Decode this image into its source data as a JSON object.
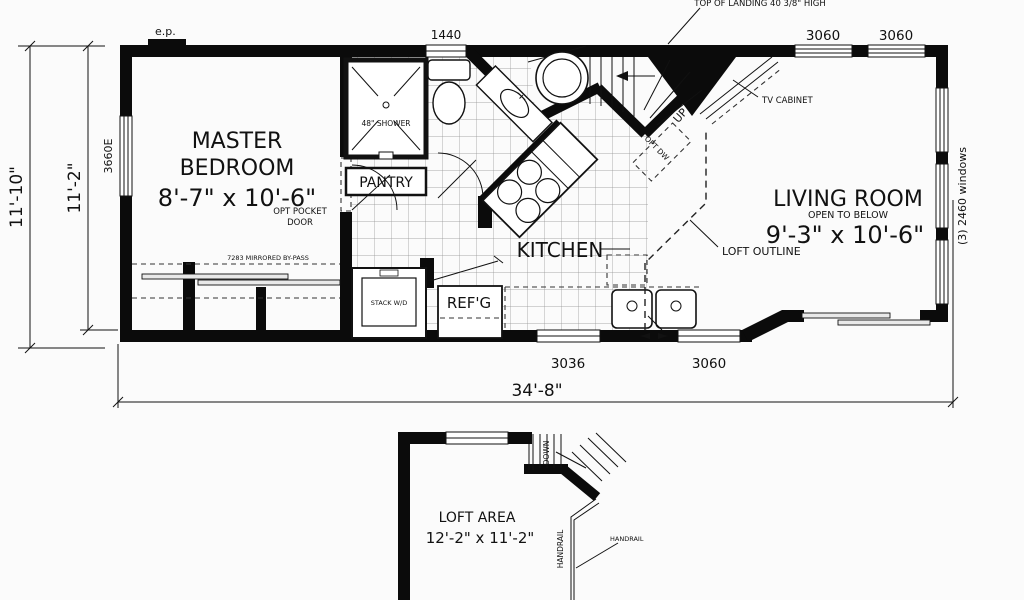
{
  "title": "Park model floor plan",
  "colors": {
    "background": "#fbfbfb",
    "ink": "#0b0b0b",
    "grid": "#8f8f8f"
  },
  "main_plan": {
    "rooms": {
      "master_bedroom": {
        "line1": "MASTER",
        "line2": "BEDROOM",
        "size": "8'-7\" x 10'-6\""
      },
      "kitchen": {
        "name": "KITCHEN"
      },
      "living_room": {
        "name": "LIVING ROOM",
        "subtitle": "OPEN TO BELOW",
        "size": "9'-3\" x 10'-6\""
      },
      "pantry": {
        "name": "PANTRY"
      }
    },
    "fixtures": {
      "shower": "48\" SHOWER",
      "stack_washer_dryer": "STACK W/D",
      "refrigerator": "REF'G",
      "opt_dishwasher": "OPT DW",
      "tv_cabinet": "TV CABINET"
    },
    "annotations": {
      "electrical_panel": "e.p.",
      "top_of_landing": "TOP OF LANDING 40 3/8\" HIGH",
      "up": "UP",
      "opt_pocket_door_line1": "OPT POCKET",
      "opt_pocket_door_line2": "DOOR",
      "mirrored_bypass": "7283 MIRRORED BY-PASS",
      "loft_outline": "LOFT OUTLINE"
    },
    "windows": {
      "top_bath": "1440",
      "top_right_1": "3060",
      "top_right_2": "3060",
      "left_bedroom": "3660E",
      "right_side": "(3) 2460 windows",
      "bottom_kitchen": "3036",
      "bottom_living": "3060"
    },
    "dimensions": {
      "overall_width": "34'-8\"",
      "overall_height": "11'-10\"",
      "interior_height": "11'-2\""
    }
  },
  "loft_plan": {
    "room": {
      "name": "LOFT AREA",
      "size": "12'-2\" x 11'-2\""
    },
    "annotations": {
      "down": "DOWN",
      "handrail_rail": "HANDRAIL",
      "handrail_callout": "HANDRAIL"
    }
  }
}
